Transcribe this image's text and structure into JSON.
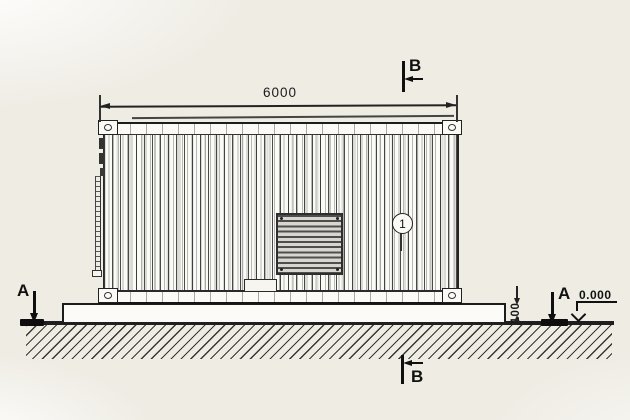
{
  "labels": {
    "length_dimension": "6000",
    "section_b": "B",
    "section_a": "A",
    "callout_1": "1",
    "pad_height": "100",
    "ground_level": "0.000"
  },
  "colors": {
    "background": "#efece4",
    "ink": "#1f1f1f",
    "paper_white": "#fbfaf6",
    "grille_slat": "#4e4e4e"
  }
}
